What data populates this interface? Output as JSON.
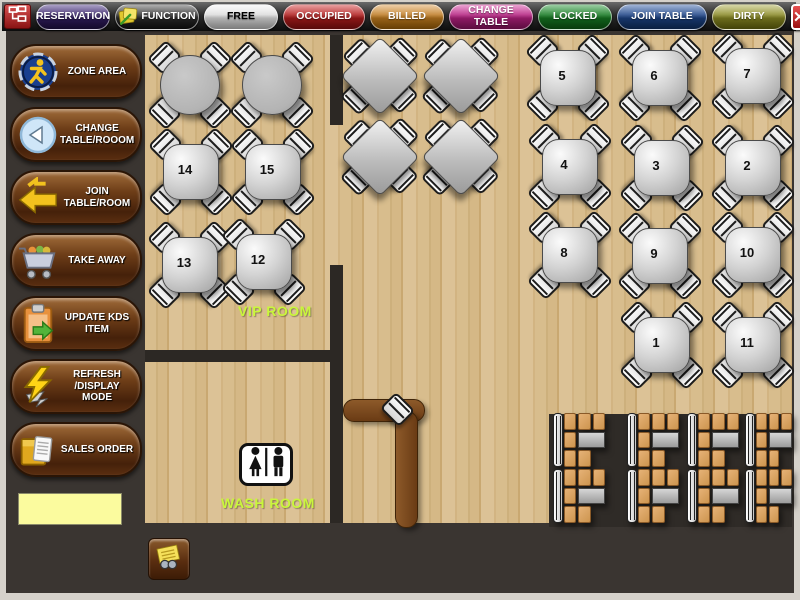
{
  "window": {
    "close_glyph": "✕"
  },
  "toolbar": {
    "buttons": [
      {
        "id": "reservation",
        "label": "RESERVATION",
        "color": "#442c7e",
        "dark": "#1f1042",
        "text": "#ffffff",
        "w": 74
      },
      {
        "id": "function",
        "label": "FUNCTION",
        "color": "#4a4a4a",
        "dark": "#101010",
        "text": "#ffffff",
        "w": 84,
        "icon": "notes"
      },
      {
        "id": "free",
        "label": "FREE",
        "color": "#f2f2f2",
        "dark": "#bcbcbc",
        "text": "#000000",
        "w": 74
      },
      {
        "id": "occupied",
        "label": "OCCUPIED",
        "color": "#cc2a2a",
        "dark": "#871010",
        "text": "#ffffff",
        "w": 82
      },
      {
        "id": "billed",
        "label": "BILLED",
        "color": "#d6913a",
        "dark": "#9c5f08",
        "text": "#ffffff",
        "w": 74
      },
      {
        "id": "change_table",
        "label": "CHANGE TABLE",
        "color": "#cf2f97",
        "dark": "#8c1260",
        "text": "#ffffff",
        "w": 84
      },
      {
        "id": "locked",
        "label": "LOCKED",
        "color": "#1f9030",
        "dark": "#0c5a14",
        "text": "#ffffff",
        "w": 74
      },
      {
        "id": "join_table",
        "label": "JOIN TABLE",
        "color": "#2a55a0",
        "dark": "#102f63",
        "text": "#ffffff",
        "w": 90
      },
      {
        "id": "dirty",
        "label": "DIRTY",
        "color": "#a2a23a",
        "dark": "#66660e",
        "text": "#ffffff",
        "w": 74
      }
    ]
  },
  "sidebar": {
    "buttons": [
      {
        "id": "zone_area",
        "label": "ZONE AREA",
        "icon": "runner"
      },
      {
        "id": "change_table_room",
        "label": "CHANGE TABLE/ROOOM",
        "icon": "back-circle"
      },
      {
        "id": "join_table_room",
        "label": "JOIN TABLE/ROOM",
        "icon": "merge-arrow"
      },
      {
        "id": "take_away",
        "label": "TAKE AWAY",
        "icon": "cart"
      },
      {
        "id": "update_kds_item",
        "label": "UPDATE KDS ITEM",
        "icon": "clipboard"
      },
      {
        "id": "refresh_display_mode",
        "label": "REFRESH /DISPLAY MODE",
        "icon": "lightning"
      },
      {
        "id": "sales_order",
        "label": "SALES ORDER",
        "icon": "order-box"
      }
    ],
    "note_value": ""
  },
  "floor": {
    "vip_label": "VIP ROOM",
    "wash_label": "WASH ROOM",
    "label_color": "#c9f63b",
    "tables": [
      {
        "label": "",
        "type": "round",
        "x": 190,
        "y": 85
      },
      {
        "label": "",
        "type": "round",
        "x": 272,
        "y": 85
      },
      {
        "label": "14",
        "type": "square",
        "x": 191,
        "y": 172
      },
      {
        "label": "15",
        "type": "square",
        "x": 273,
        "y": 172
      },
      {
        "label": "13",
        "type": "square",
        "x": 190,
        "y": 265
      },
      {
        "label": "12",
        "type": "square",
        "x": 264,
        "y": 262
      },
      {
        "label": "",
        "type": "diamond",
        "x": 380,
        "y": 76
      },
      {
        "label": "",
        "type": "diamond",
        "x": 461,
        "y": 76
      },
      {
        "label": "",
        "type": "diamond",
        "x": 380,
        "y": 157
      },
      {
        "label": "",
        "type": "diamond",
        "x": 461,
        "y": 157
      },
      {
        "label": "5",
        "type": "square",
        "x": 568,
        "y": 78
      },
      {
        "label": "6",
        "type": "square",
        "x": 660,
        "y": 78
      },
      {
        "label": "7",
        "type": "square",
        "x": 753,
        "y": 76
      },
      {
        "label": "4",
        "type": "square",
        "x": 570,
        "y": 167
      },
      {
        "label": "3",
        "type": "square",
        "x": 662,
        "y": 168
      },
      {
        "label": "2",
        "type": "square",
        "x": 753,
        "y": 168
      },
      {
        "label": "8",
        "type": "square",
        "x": 570,
        "y": 255
      },
      {
        "label": "9",
        "type": "square",
        "x": 660,
        "y": 256
      },
      {
        "label": "10",
        "type": "square",
        "x": 753,
        "y": 255
      },
      {
        "label": "1",
        "type": "square",
        "x": 662,
        "y": 345
      },
      {
        "label": "11",
        "type": "square",
        "x": 753,
        "y": 345
      }
    ],
    "booths": [
      {
        "x": 553,
        "y": 413,
        "w": 52
      },
      {
        "x": 627,
        "y": 413,
        "w": 52
      },
      {
        "x": 687,
        "y": 413,
        "w": 52
      },
      {
        "x": 745,
        "y": 413,
        "w": 47
      },
      {
        "x": 553,
        "y": 469,
        "w": 52
      },
      {
        "x": 627,
        "y": 469,
        "w": 52
      },
      {
        "x": 687,
        "y": 469,
        "w": 52
      },
      {
        "x": 745,
        "y": 469,
        "w": 47
      }
    ]
  }
}
